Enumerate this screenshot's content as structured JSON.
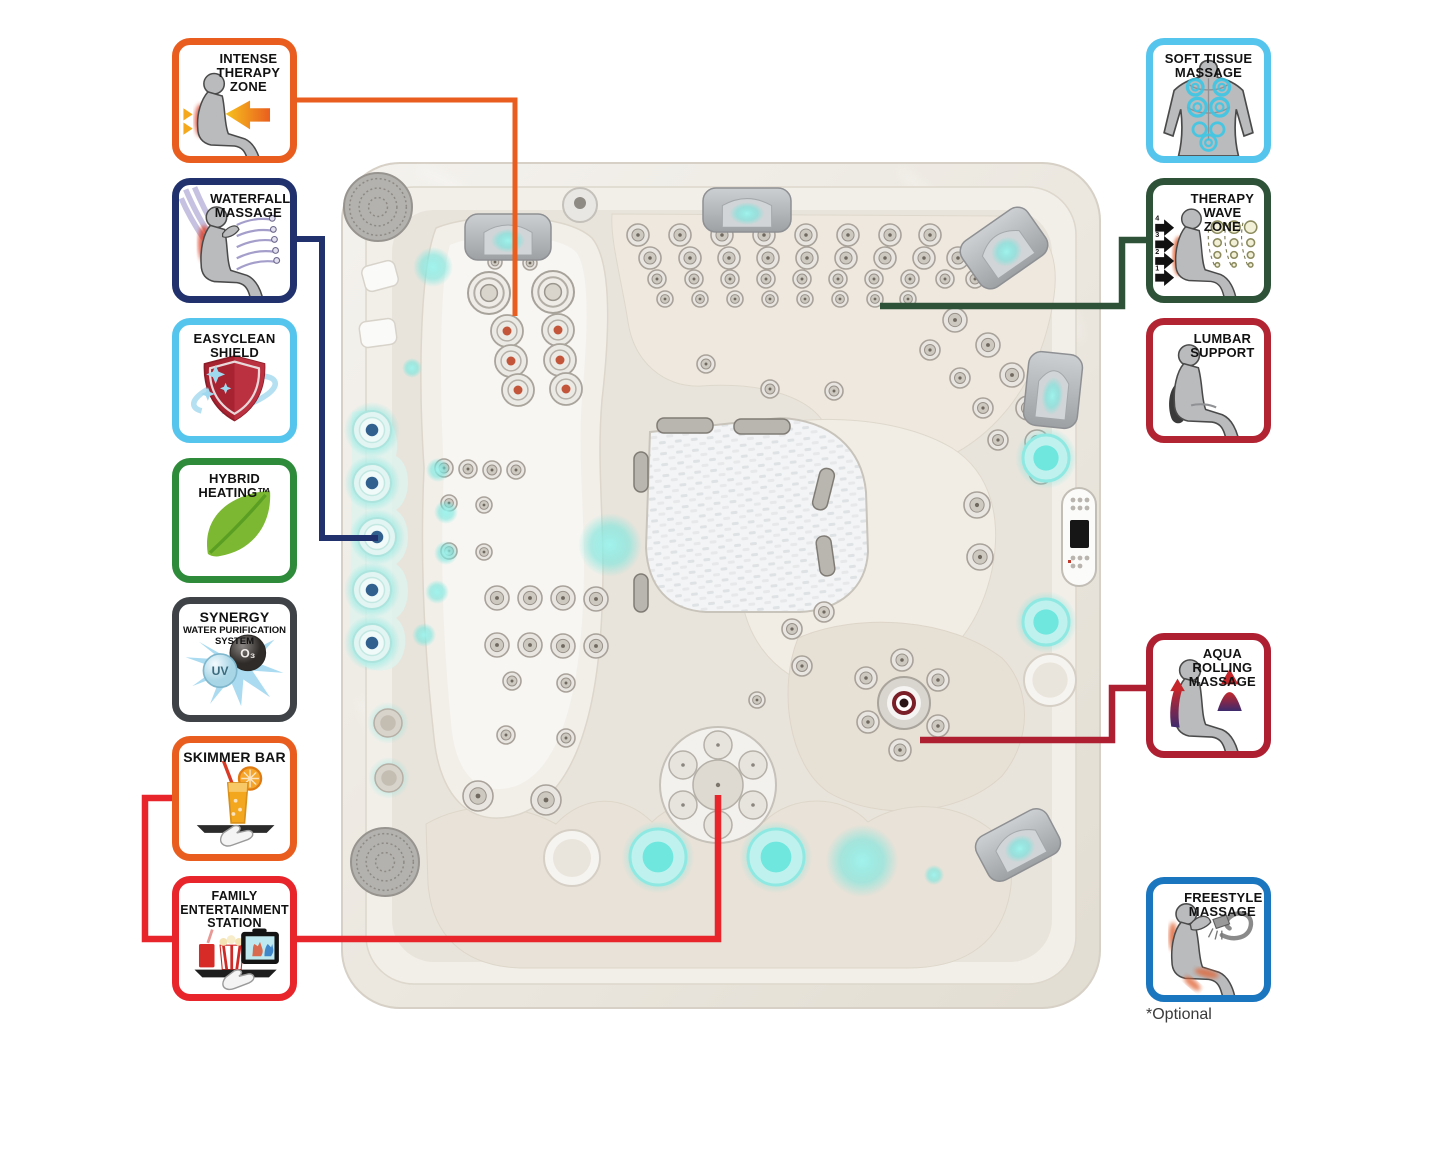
{
  "page": {
    "background": "#ffffff",
    "optional_note": "*Optional"
  },
  "badges": {
    "left": [
      {
        "id": "intense-therapy-zone",
        "label": "INTENSE\nTHERAPY\nZONE",
        "border_color": "#E95E1E",
        "top": 38
      },
      {
        "id": "waterfall-massage",
        "label": "WATERFALL\nMASSAGE",
        "border_color": "#20316E",
        "top": 178
      },
      {
        "id": "easyclean-shield",
        "label": "EASYCLEAN\nSHIELD",
        "border_color": "#56C5EE",
        "top": 318
      },
      {
        "id": "hybrid-heating",
        "label": "HYBRID\nHEATING™",
        "border_color": "#2E8B3A",
        "top": 458
      },
      {
        "id": "synergy-system",
        "label": "SYNERGY",
        "sublabel": "WATER PURIFICATION\nSYSTEM",
        "border_color": "#3F4347",
        "top": 597,
        "o3_label": "O₃",
        "uv_label": "UV"
      },
      {
        "id": "skimmer-bar",
        "label": "SKIMMER BAR",
        "border_color": "#E95E1E",
        "top": 736
      },
      {
        "id": "family-entertainment-station",
        "label": "FAMILY\nENTERTAINMENT\nSTATION",
        "border_color": "#E8252B",
        "top": 876
      }
    ],
    "right": [
      {
        "id": "soft-tissue-massage",
        "label": "SOFT TISSUE\nMASSAGE",
        "border_color": "#56C5EE",
        "top": 38
      },
      {
        "id": "therapy-wave-zone",
        "label": "THERAPY\nWAVE ZONE",
        "border_color": "#2D5237",
        "top": 178,
        "numbers": [
          "4",
          "3",
          "2",
          "1"
        ]
      },
      {
        "id": "lumbar-support",
        "label": "LUMBAR\nSUPPORT",
        "border_color": "#B22432",
        "top": 318
      },
      {
        "id": "aqua-rolling-massage",
        "label": "AQUA\nROLLING\nMASSAGE",
        "border_color": "#AE1F32",
        "top": 633
      },
      {
        "id": "freestyle-massage",
        "label": "FREESTYLE\nMASSAGE",
        "border_color": "#1B76C0",
        "top": 877
      }
    ]
  },
  "connectors": {
    "intense": {
      "color": "#E95E1E",
      "width": 5,
      "points": "297,100 515,100 515,316"
    },
    "waterfall": {
      "color": "#20316E",
      "width": 6,
      "points": "297,239 322,239 322,538 378,538"
    },
    "therapy_wave": {
      "color": "#2D5237",
      "width": 6.5,
      "points": "880,306 1122,306 1122,240 1146,240"
    },
    "aqua_rolling": {
      "color": "#AE1F32",
      "width": 6.5,
      "points": "920,740 1112,740 1112,688 1147,688"
    },
    "family_skimmer": {
      "color": "#E8252B",
      "width": 6.5,
      "points": "172,798 145,798 145,939 718,939 718,795"
    }
  },
  "tub": {
    "accent_cyan": "#6FE6DE",
    "shell_light": "#f3f1ec",
    "shell_dark": "#e3ded4",
    "speakers": [
      [
        378,
        207,
        34
      ],
      [
        385,
        862,
        34
      ]
    ],
    "headrests": [
      [
        508,
        237,
        86,
        46,
        0
      ],
      [
        747,
        210,
        88,
        44,
        0
      ],
      [
        1004,
        248,
        80,
        56,
        -35
      ],
      [
        1053,
        390,
        54,
        74,
        6
      ],
      [
        1018,
        845,
        80,
        50,
        -28
      ]
    ],
    "jets": {
      "swirl": [
        [
          489,
          293,
          21
        ],
        [
          553,
          292,
          21
        ]
      ],
      "orange_core": [
        [
          507,
          331,
          16
        ],
        [
          558,
          330,
          16
        ],
        [
          511,
          361,
          16
        ],
        [
          560,
          360,
          16
        ],
        [
          518,
          390,
          16
        ],
        [
          566,
          389,
          16
        ]
      ],
      "navy_core": [
        [
          372,
          430,
          19
        ],
        [
          372,
          483,
          19
        ],
        [
          377,
          537,
          19
        ],
        [
          372,
          590,
          19
        ],
        [
          372,
          643,
          19
        ]
      ],
      "flower": [
        [
          388,
          723,
          14
        ],
        [
          389,
          778,
          14
        ]
      ],
      "small": [
        [
          638,
          235,
          11
        ],
        [
          680,
          235,
          11
        ],
        [
          722,
          235,
          11
        ],
        [
          764,
          235,
          11
        ],
        [
          806,
          235,
          11
        ],
        [
          848,
          235,
          11
        ],
        [
          890,
          235,
          11
        ],
        [
          930,
          235,
          11
        ],
        [
          650,
          258,
          11
        ],
        [
          690,
          258,
          11
        ],
        [
          729,
          258,
          11
        ],
        [
          768,
          258,
          11
        ],
        [
          807,
          258,
          11
        ],
        [
          846,
          258,
          11
        ],
        [
          885,
          258,
          11
        ],
        [
          924,
          258,
          11
        ],
        [
          958,
          258,
          11
        ],
        [
          657,
          279,
          9
        ],
        [
          694,
          279,
          9
        ],
        [
          730,
          279,
          9
        ],
        [
          766,
          279,
          9
        ],
        [
          802,
          279,
          9
        ],
        [
          838,
          279,
          9
        ],
        [
          874,
          279,
          9
        ],
        [
          910,
          279,
          9
        ],
        [
          945,
          279,
          9
        ],
        [
          975,
          279,
          9
        ],
        [
          665,
          299,
          8
        ],
        [
          700,
          299,
          8
        ],
        [
          735,
          299,
          8
        ],
        [
          770,
          299,
          8
        ],
        [
          805,
          299,
          8
        ],
        [
          840,
          299,
          8
        ],
        [
          875,
          299,
          8
        ],
        [
          908,
          299,
          8
        ],
        [
          955,
          320,
          12
        ],
        [
          988,
          345,
          12
        ],
        [
          1012,
          375,
          12
        ],
        [
          1028,
          408,
          12
        ],
        [
          1037,
          442,
          12
        ],
        [
          1041,
          472,
          12
        ],
        [
          930,
          350,
          10
        ],
        [
          960,
          378,
          10
        ],
        [
          983,
          408,
          10
        ],
        [
          998,
          440,
          10
        ],
        [
          706,
          364,
          9
        ],
        [
          770,
          389,
          9
        ],
        [
          834,
          391,
          9
        ],
        [
          444,
          468,
          9
        ],
        [
          468,
          469,
          9
        ],
        [
          492,
          470,
          9
        ],
        [
          516,
          470,
          9
        ],
        [
          449,
          503,
          8
        ],
        [
          484,
          505,
          8
        ],
        [
          449,
          551,
          8
        ],
        [
          484,
          552,
          8
        ],
        [
          497,
          598,
          12
        ],
        [
          530,
          598,
          12
        ],
        [
          563,
          598,
          12
        ],
        [
          596,
          599,
          12
        ],
        [
          497,
          645,
          12
        ],
        [
          530,
          645,
          12
        ],
        [
          563,
          646,
          12
        ],
        [
          596,
          646,
          12
        ],
        [
          512,
          681,
          9
        ],
        [
          566,
          683,
          9
        ],
        [
          506,
          735,
          9
        ],
        [
          566,
          738,
          9
        ],
        [
          478,
          796,
          15
        ],
        [
          546,
          800,
          15
        ],
        [
          977,
          505,
          13
        ],
        [
          980,
          557,
          13
        ],
        [
          866,
          678,
          11
        ],
        [
          902,
          660,
          11
        ],
        [
          938,
          680,
          11
        ],
        [
          868,
          722,
          11
        ],
        [
          938,
          726,
          11
        ],
        [
          900,
          750,
          11
        ],
        [
          792,
          629,
          10
        ],
        [
          802,
          666,
          10
        ],
        [
          824,
          612,
          10
        ],
        [
          757,
          700,
          8
        ],
        [
          495,
          262,
          7
        ],
        [
          530,
          263,
          7
        ]
      ],
      "drain": [
        904,
        703,
        24
      ]
    },
    "cyan_cups": [
      [
        1046,
        458,
        23
      ],
      [
        1046,
        622,
        23
      ],
      [
        658,
        857,
        28
      ],
      [
        776,
        857,
        28
      ]
    ],
    "white_circles": [
      [
        572,
        858,
        28
      ],
      [
        1050,
        680,
        26
      ]
    ],
    "glow_dots": [
      [
        433,
        267,
        10
      ],
      [
        438,
        470,
        6
      ],
      [
        446,
        512,
        6
      ],
      [
        446,
        553,
        6
      ],
      [
        437,
        592,
        6
      ],
      [
        424,
        635,
        6
      ],
      [
        412,
        368,
        5
      ],
      [
        610,
        545,
        16
      ],
      [
        934,
        875,
        5
      ],
      [
        862,
        861,
        18
      ]
    ],
    "pads": [
      [
        380,
        276,
        34,
        26,
        -15
      ],
      [
        378,
        333,
        36,
        26,
        -8
      ]
    ]
  }
}
